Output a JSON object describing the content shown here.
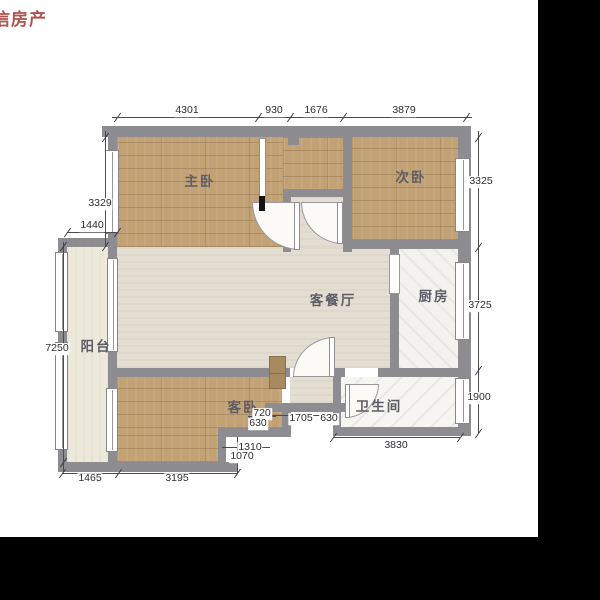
{
  "watermark": {
    "text": "信房产"
  },
  "rooms": {
    "master": {
      "label": "主卧"
    },
    "second": {
      "label": "次卧"
    },
    "living": {
      "label": "客餐厅"
    },
    "kitchen": {
      "label": "厨房"
    },
    "balcony": {
      "label": "阳台"
    },
    "guest": {
      "label": "客卧"
    },
    "bath": {
      "label": "卫生间"
    }
  },
  "dimensions": {
    "top": [
      "4301",
      "930",
      "1676",
      "3879"
    ],
    "left": {
      "master_height": "3329",
      "balcony_width": "1440",
      "total_height": "7250"
    },
    "right": [
      "3325",
      "3725",
      "1900"
    ],
    "bottom": [
      "1465",
      "3195"
    ],
    "inner": {
      "entry_a": "720",
      "entry_b": "630",
      "vestibule": "1705",
      "vestibule_b": "630",
      "notch_a": "1310",
      "notch_b": "1070",
      "bath_width": "3830"
    }
  },
  "colors": {
    "wall": "#8d8d91",
    "wood_floor": "#c2a174",
    "living_floor": "#e4ded2",
    "balcony_floor": "#edeadc",
    "kitchen_floor": "#f3f2ee",
    "bath_floor": "#f6f5f1",
    "watermark_red": "#b0524e",
    "background": "#ffffff",
    "crop_bar": "#000000"
  }
}
